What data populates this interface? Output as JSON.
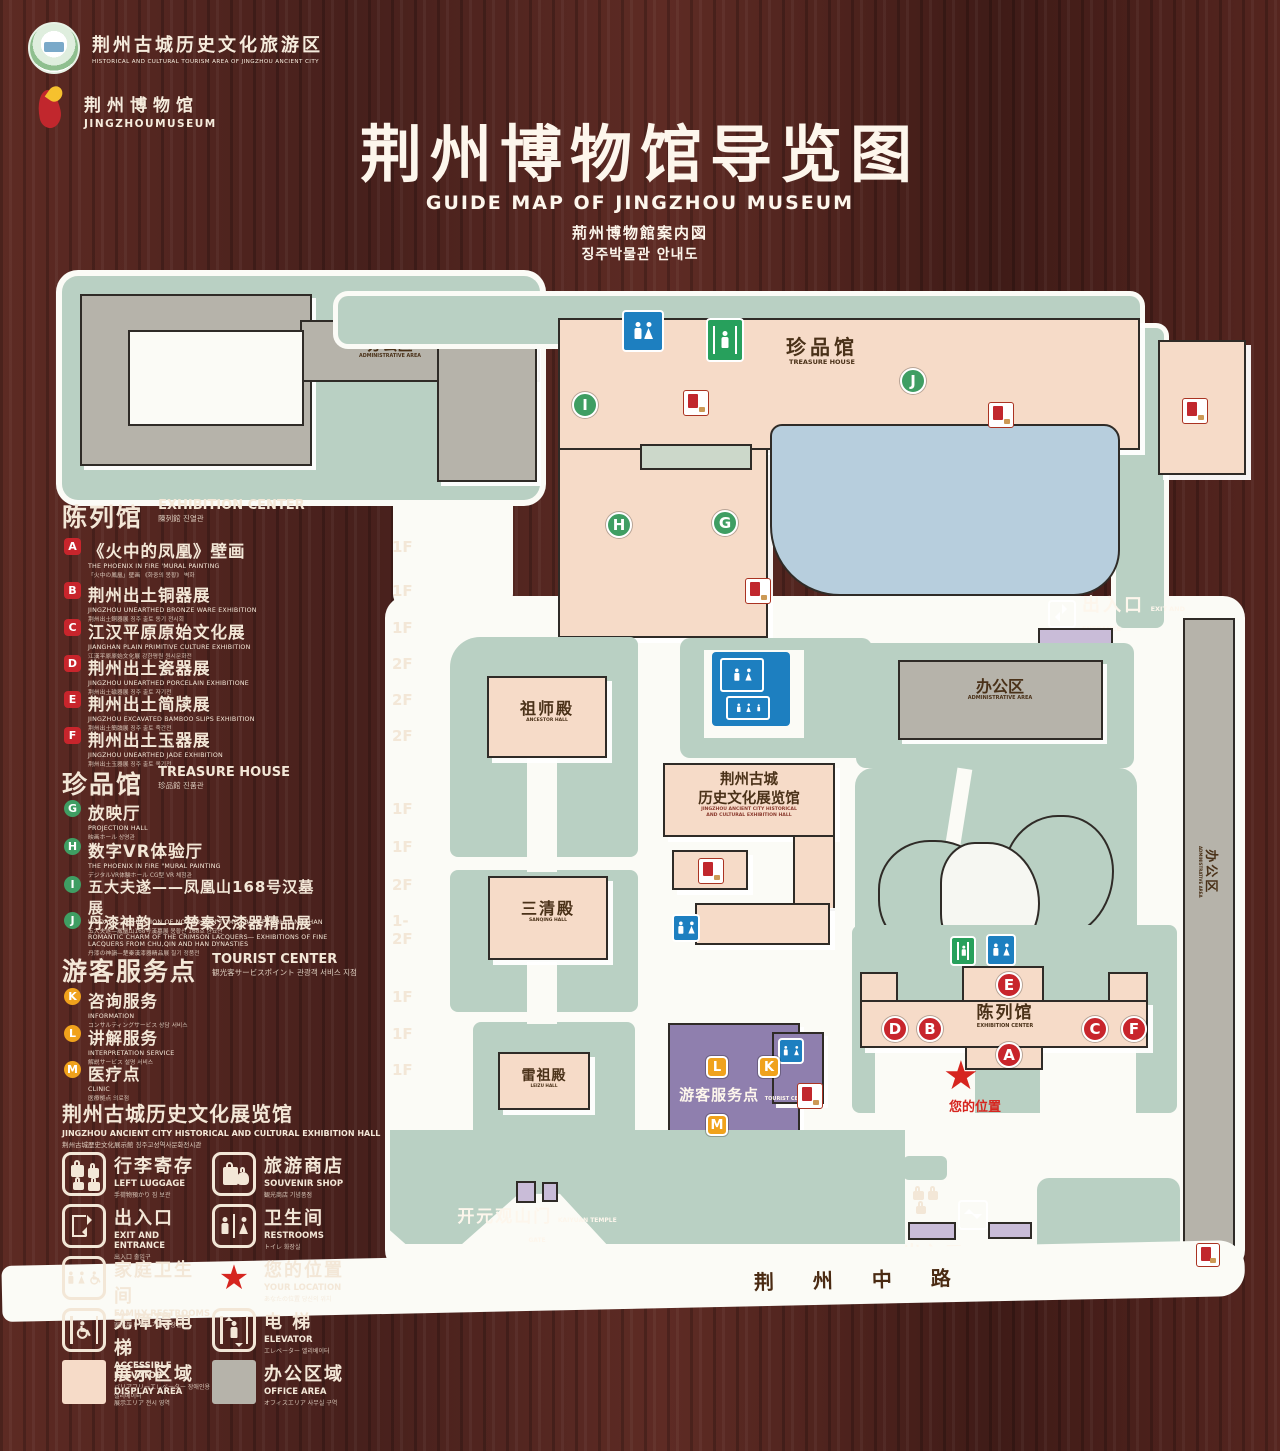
{
  "header": {
    "logo1": {
      "zh": "荆州古城历史文化旅游区",
      "en": "HISTORICAL AND CULTURAL TOURISM AREA OF JINGZHOU ANCIENT CITY"
    },
    "logo2": {
      "zh": "荆州博物馆",
      "en": "JINGZHOUMUSEUM"
    },
    "title_zh": "荆州博物馆导览图",
    "title_en": "GUIDE MAP OF JINGZHOU MUSEUM",
    "title_ja": "荊州博物館案内図",
    "title_ko": "징주박물관 안내도"
  },
  "legend": {
    "sections": [
      {
        "zh": "陈列馆",
        "en": "EXHIBITION CENTER",
        "sub": "陳列館  진열관",
        "items": [
          {
            "letter": "A",
            "zh": "《火中的凤凰》壁画",
            "en": "THE PHOENIX IN FIRE 'MURAL PAINTING",
            "sub": "「火中の鳳凰」壁画 《화중의 봉황》 벽화",
            "floor": "1F"
          },
          {
            "letter": "B",
            "zh": "荆州出土铜器展",
            "en": "JINGZHOU UNEARTHED BRONZE WARE EXHIBITION",
            "sub": "荆州出土銅器展  징주 출토 동기 전시회",
            "floor": "1F"
          },
          {
            "letter": "C",
            "zh": "江汉平原原始文化展",
            "en": "JIANGHAN PLAIN PRIMITIVE CULTURE EXHIBITION",
            "sub": "江漢平原原始文化展  강한평원 원시문화전",
            "floor": "1F"
          },
          {
            "letter": "D",
            "zh": "荆州出土瓷器展",
            "en": "JINGZHOU UNEARTHED PORCELAIN EXHIBITIONE",
            "sub": "荆州出土磁器展  징주 출토 자기전",
            "floor": "2F"
          },
          {
            "letter": "E",
            "zh": "荆州出土简牍展",
            "en": "JINGZHOU EXCAVATED BAMBOO SLIPS EXHIBITION",
            "sub": "荆州出土簡牘展  징주 출토 죽간전",
            "floor": "2F"
          },
          {
            "letter": "F",
            "zh": "荆州出土玉器展",
            "en": "JINGZHOU UNEARTHED JADE EXHIBITION",
            "sub": "荆州出土玉器展  징주 출토 옥기전",
            "floor": "2F"
          }
        ]
      },
      {
        "zh": "珍品馆",
        "en": "TREASURE HOUSE",
        "sub": "珍品館  진품관",
        "items": [
          {
            "letter": "G",
            "zh": "放映厅",
            "en": "PROJECTION HALL",
            "sub": "映画ホール  상영관",
            "floor": "1F"
          },
          {
            "letter": "H",
            "zh": "数字VR体验厅",
            "en": "THE PHOENIX IN FIRE \"MURAL PAINTING",
            "sub": "デジタルVR体験ホール  CG型 VR 체험관",
            "floor": "1F"
          },
          {
            "letter": "I",
            "zh": "五大夫遂——凤凰山168号汉墓展",
            "en": "WUDAFU—EXHIBITION OF NO.168 HAN TOMB FROM FENGHUANGSHAN",
            "sub": "五大夫遂—鳳凰山168号漢墓展  봉황산 168호 한묘전",
            "floor": "2F"
          },
          {
            "letter": "J",
            "zh": "丹漆神韵——楚秦汉漆器精品展",
            "en": "ROMANTIC CHARM OF THE CRIMSON LACQUERS— EXHIBITIONS OF FINE LACQUERS FROM CHU,QIN AND HAN DYNASTIES",
            "sub": "丹漆の神韻—楚秦漢漆器精品展  칠기 정품전",
            "floor": "1-2F"
          }
        ]
      },
      {
        "zh": "游客服务点",
        "en": "TOURIST CENTER",
        "sub": "観光客サービスポイント  관광객 서비스 지점",
        "items": [
          {
            "letter": "K",
            "zh": "咨询服务",
            "en": "INFORMATION",
            "sub": "コンサルティングサービス  상담 서비스",
            "floor": "1F"
          },
          {
            "letter": "L",
            "zh": "讲解服务",
            "en": "INTERPRETATION SERVICE",
            "sub": "解説サービス  설명 서비스",
            "floor": "1F"
          },
          {
            "letter": "M",
            "zh": "医疗点",
            "en": "CLINIC",
            "sub": "医療拠点  의료점",
            "floor": "1F"
          }
        ]
      }
    ],
    "hall_title": {
      "zh": "荆州古城历史文化展览馆",
      "en": "JINGZHOU ANCIENT CITY HISTORICAL AND CULTURAL EXHIBITION HALL",
      "sub": "荆州古城歴史文化展示館    징주고성역사문화전시관"
    },
    "icons": [
      {
        "id": "left-luggage",
        "zh": "行李寄存",
        "en": "LEFT LUGGAGE",
        "sub": "手荷物預かり  짐 보관"
      },
      {
        "id": "souvenir-shop",
        "zh": "旅游商店",
        "en": "SOUVENIR SHOP",
        "sub": "観光商店  기념품점"
      },
      {
        "id": "exit-entrance",
        "zh": "出入口",
        "en": "EXIT AND ENTRANCE",
        "sub": "出入口  출입구"
      },
      {
        "id": "restrooms",
        "zh": "卫生间",
        "en": "RESTROOMS",
        "sub": "トイレ  화장실"
      },
      {
        "id": "family-restrooms",
        "zh": "家庭卫生间",
        "en": "FAMILY RESTROOMS",
        "sub": "家族用トイレ  가족 화장실"
      },
      {
        "id": "your-location",
        "zh": "您的位置",
        "en": "YOUR LOCATION",
        "sub": "あなたの位置  당신의 위치"
      },
      {
        "id": "accessible-elevator",
        "zh": "无障碍电梯",
        "en": "ACCESSIBLE ELEVATOR",
        "sub": "バリアフリーエレベーター  장애인용 엘리베이터"
      },
      {
        "id": "elevator",
        "zh": "电  梯",
        "en": "ELEVATOR",
        "sub": "エレベーター  엘리베이터"
      },
      {
        "id": "display-area",
        "zh": "展示区域",
        "en": "DISPLAY AREA",
        "sub": "展示エリア  전시 영역"
      },
      {
        "id": "office-area",
        "zh": "办公区域",
        "en": "OFFICE AREA",
        "sub": "オフィスエリア  사무실 구역"
      }
    ]
  },
  "map": {
    "labels": {
      "admin_top": {
        "zh": "办公区",
        "en": "ADMINISTRATIVE AREA"
      },
      "treasure_house": {
        "zh": "珍品馆",
        "en": "TREASURE HOUSE"
      },
      "exit_top": {
        "zh": "出入口",
        "en": "EXIT AND ENTRANCE"
      },
      "admin_right": {
        "zh": "办公区",
        "en": "ADMINISTRATIVE AREA"
      },
      "admin_strip": {
        "zh": "办公区",
        "en": "ADMINISTRATIVE AREA"
      },
      "ancestor_hall": {
        "zh": "祖师殿",
        "en": "ANCESTOR HALL"
      },
      "sanqing_hall": {
        "zh": "三清殿",
        "en": "SANQING HALL"
      },
      "leizu_hall": {
        "zh": "雷祖殿",
        "en": "LEIZU HALL"
      },
      "exhibition_hall": {
        "zh1": "荆州古城",
        "zh2": "历史文化展览馆",
        "en1": "JINGZHOU ANCIENT CITY HISTORICAL",
        "en2": "AND CULTURAL EXHIBITION HALL"
      },
      "exhibition_center": {
        "zh": "陈列馆",
        "en": "EXHIBITION CENTER"
      },
      "tourist_center": {
        "zh": "游客服务点",
        "en": "TOURIST CENTER"
      },
      "your_location": {
        "zh": "您的位置"
      },
      "temple_gate": {
        "zh": "开元观山门",
        "en": "KAIYUAN TEMPLE GATE"
      },
      "exit_bottom": {
        "zh": "出入口",
        "en": "EXIT AND ENTRANCE"
      },
      "road": {
        "zh": "荆 州 中 路"
      }
    },
    "markers": [
      {
        "letter": "I",
        "color": "green"
      },
      {
        "letter": "J",
        "color": "green"
      },
      {
        "letter": "H",
        "color": "green"
      },
      {
        "letter": "G",
        "color": "green"
      },
      {
        "letter": "E",
        "color": "red"
      },
      {
        "letter": "D",
        "color": "red"
      },
      {
        "letter": "B",
        "color": "red"
      },
      {
        "letter": "C",
        "color": "red"
      },
      {
        "letter": "F",
        "color": "red"
      },
      {
        "letter": "A",
        "color": "red"
      },
      {
        "letter": "L",
        "color": "orange"
      },
      {
        "letter": "K",
        "color": "orange"
      },
      {
        "letter": "M",
        "color": "orange"
      }
    ],
    "location_star": "★"
  },
  "colors": {
    "wood": "#4e221d",
    "map_green": "#b9d0c3",
    "building_pink": "#f6dbc8",
    "building_gray": "#b6b3aa",
    "water_blue": "#b7cedd",
    "tourist_purple": "#8f7fae",
    "gate_purple": "#c9bcd8",
    "marker_red": "#c8252c",
    "marker_green": "#3f9e63",
    "marker_orange": "#f0a21c",
    "restroom_blue": "#1d7fc0",
    "elevator_green": "#27a05c",
    "star_red": "#d6251f",
    "cream_text": "#f3e7d7"
  }
}
